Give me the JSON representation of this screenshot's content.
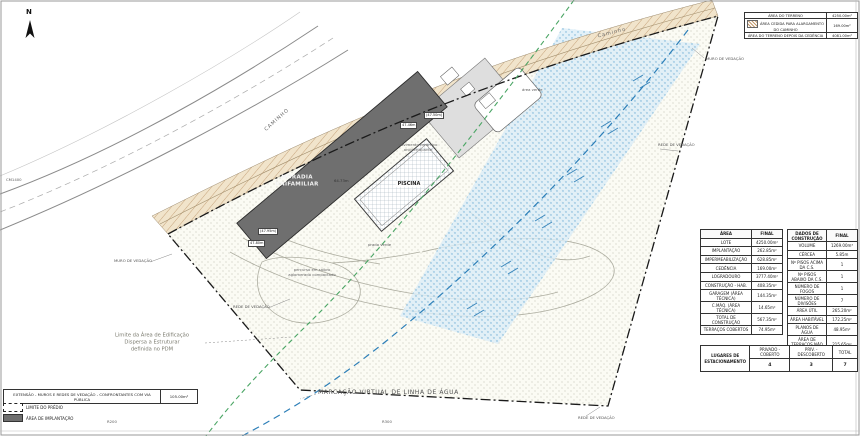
{
  "compass": {
    "north_label": "N"
  },
  "top_table": {
    "rows": [
      {
        "label": "ÁREA DO TERRENO",
        "value": "4250.00m²"
      },
      {
        "label": "ÁREA CEDIDA PARA ALARGAMENTO DO CAMINHO",
        "value": "169.00m²"
      },
      {
        "label": "ÁREA DO TERRENO DEPOIS DA CEDÊNCIA",
        "value": "4081.00m²"
      }
    ]
  },
  "area_table": {
    "header_label": "ÁREA",
    "header_value": "FINAL",
    "rows": [
      {
        "label": "LOTE",
        "value": "4250.00m²"
      },
      {
        "label": "IMPLANTAÇÃO",
        "value": "262.85m²"
      },
      {
        "label": "IMPERMEABILIZAÇÃO",
        "value": "628.85m²"
      },
      {
        "label": "CEDÊNCIA",
        "value": "169.00m²"
      },
      {
        "label": "LOGRADOURO",
        "value": "3777.40m²"
      },
      {
        "label": "CONSTRUÇÃO - HAB.",
        "value": "408.35m²"
      },
      {
        "label": "GARAGEM (ÁREA TÉCNICA)",
        "value": "144.35m²"
      },
      {
        "label": "C.MÁQ. (ÁREA TÉCNICA)",
        "value": "14.65m²"
      },
      {
        "label": "TOTAL DE CONSTRUÇÃO",
        "value": "567.35m²"
      },
      {
        "label": "TERRAÇOS COBERTOS",
        "value": "74.95m²"
      }
    ]
  },
  "construction_table": {
    "header_label": "DADOS DE CONSTRUÇÃO",
    "header_value": "FINAL",
    "rows": [
      {
        "label": "VOLUME",
        "value": "1269.00m³"
      },
      {
        "label": "CÉRCEA",
        "value": "5.85m"
      },
      {
        "label": "Nº PISOS ACIMA DA C.S.",
        "value": "1"
      },
      {
        "label": "Nº PISOS ABAIXO DA C.S.",
        "value": "1"
      },
      {
        "label": "NÚMERO DE FOGOS",
        "value": "1"
      },
      {
        "label": "NÚMERO DE DIVISÕES",
        "value": "7"
      },
      {
        "label": "ÁREA ÚTIL",
        "value": "265.20m²"
      },
      {
        "label": "ÁREA HABITÁVEL",
        "value": "172.25m²"
      },
      {
        "label": "PLANOS DE ÁGUA",
        "value": "48.95m²"
      },
      {
        "label": "ÁREA DE TERRAÇOS NÃO COB.",
        "value": "215.65m²"
      }
    ]
  },
  "parking_table": {
    "title_line1": "LUGARES DE",
    "title_line2": "ESTACIONAMENTO",
    "columns": [
      {
        "label": "PRIVADO - COBERTO",
        "value": "4"
      },
      {
        "label": "PRIV. - DESCOBERTO",
        "value": "3"
      },
      {
        "label": "TOTAL",
        "value": "7"
      }
    ]
  },
  "extension_box": {
    "label": "EXTENSÃO - MUROS E REDES DE VEDAÇÃO - CONFRONTANTES COM VIA PÚBLICA",
    "value": "105.00m²"
  },
  "legend": {
    "limit_label": "LIMITE DO PRÉDIO",
    "implantation_label": "ÁREA DE IMPLANTAÇÃO"
  },
  "plan": {
    "building_line1": "MORADIA",
    "building_line2": "UNIFAMILIAR",
    "pool_label": "PISCINA",
    "water_line_label": "MARCAÇÃO VIRTUAL DE LINHA DE ÁGUA",
    "pdm_line1": "Limite da Área de Edificação",
    "pdm_line2": "Dispersa a Estruturar",
    "pdm_line3": "definida no PDM",
    "road_label_left": "CAMINHO",
    "road_label_top": "Caminho",
    "road_code": "CM1400",
    "wall_label": "MURO DE VEDAÇÃO",
    "fence_label": "REDE DE VEDAÇÃO",
    "pavement_note_line1": "pavimento cerâmico",
    "pavement_note_line2": "antiderrapante",
    "path_note_line1": "percurso em saibro",
    "path_note_line2": "aglomerado compactado",
    "lawn_label": "prado verde",
    "green_area_label": "área verde",
    "tick_label_1": "R200",
    "tick_label_2": "R300",
    "elev_1": "(47.95m)",
    "elev_2": "47.80m",
    "elev_3": "(47.50m)",
    "elev_4": "47.46m",
    "dim_1": "64.73m"
  },
  "colors": {
    "water_line": "#2d7fb8",
    "pdm_line": "#4aa564",
    "building_fill": "#6f6f6f",
    "road_hatch": "#b08a5e",
    "water_fill": "#dcedf8"
  }
}
